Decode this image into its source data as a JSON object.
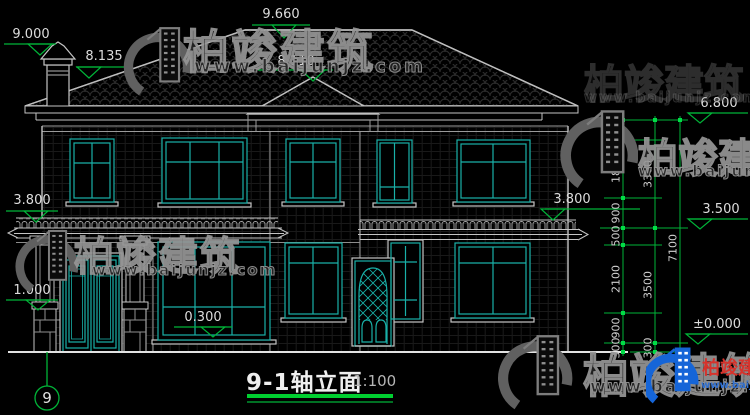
{
  "title": {
    "text": "9-1轴立面",
    "scale": "1:100",
    "axis_number": "9"
  },
  "elevations": {
    "chimney_top": "9.000",
    "roof_left": "8.135",
    "ridge": "9.660",
    "bay_hip": "8.110",
    "eave": "6.800",
    "porch_roof": "3.800",
    "annex_eave": "3.800",
    "second_floor": "3.500",
    "pedestal": "1.000",
    "first_floor": "0.300",
    "ground": "±0.000"
  },
  "dims": {
    "inner": [
      "600",
      "1800",
      "900",
      "500",
      "2100",
      "900",
      "300"
    ],
    "middle": [
      "3300",
      "3500",
      "300"
    ],
    "overall": "7100"
  },
  "watermark": {
    "brand": "柏竣建筑",
    "url": "www.baijunjz.com"
  },
  "brand_logo": {
    "brand": "柏竣建筑",
    "url": "www.baijunjz.com"
  },
  "colors": {
    "dim_green": "#00b438",
    "window_teal": "#19b0a8",
    "line_white": "#c4c4c4",
    "brand_blue": "#1565d8",
    "brand_red": "#d6332c"
  }
}
